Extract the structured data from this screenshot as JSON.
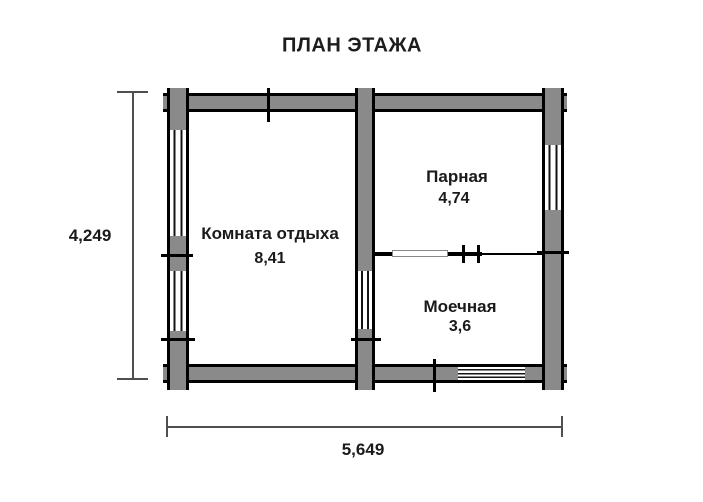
{
  "title": "ПЛАН ЭТАЖА",
  "rooms": [
    {
      "name": "Комната отдыха",
      "area": "8,41"
    },
    {
      "name": "Парная",
      "area": "4,74"
    },
    {
      "name": "Моечная",
      "area": "3,6"
    }
  ],
  "dimensions": {
    "height_label": "4,249",
    "width_label": "5,649"
  },
  "colors": {
    "wall_fill": "#8a8a8a",
    "wall_outline": "#000000",
    "dimension_line": "#4f4f4f",
    "text": "#1a1a1a",
    "background": "#ffffff"
  }
}
